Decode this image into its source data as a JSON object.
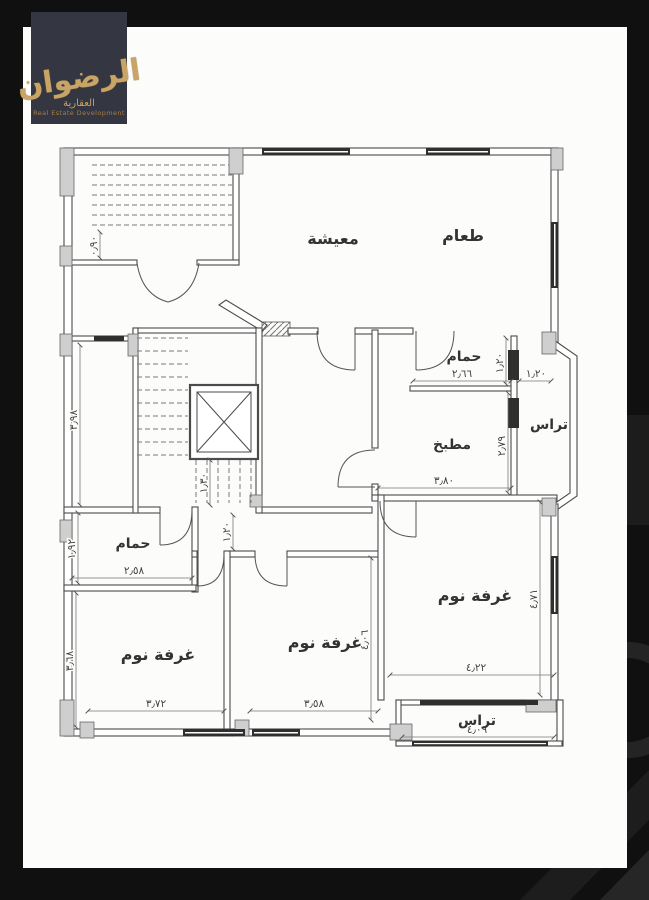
{
  "canvas": {
    "background": "#101010",
    "sheet_color": "#fcfcfa"
  },
  "logo": {
    "calligraphy": "الرضوان",
    "subtitle": "العقارية",
    "tagline": "Real Estate Development",
    "background": "#343641",
    "gold": "#c8a566"
  },
  "plan": {
    "line_color": "#4b4b4b",
    "rooms": [
      {
        "id": "living",
        "label": "معيشة"
      },
      {
        "id": "dining",
        "label": "طعام"
      },
      {
        "id": "bathroom-top",
        "label": "حمام"
      },
      {
        "id": "terrace-right",
        "label": "تراس"
      },
      {
        "id": "kitchen",
        "label": "مطبخ"
      },
      {
        "id": "bathroom-left",
        "label": "حمام"
      },
      {
        "id": "bedroom-left",
        "label": "غرفة نوم"
      },
      {
        "id": "bedroom-middle",
        "label": "غرفة نوم"
      },
      {
        "id": "bedroom-right",
        "label": "غرفة نوم"
      },
      {
        "id": "terrace-bottom",
        "label": "تراس"
      }
    ],
    "dimensions": {
      "bath_top_width": "٢٫٦٦",
      "bath_top_height": "١٫٢٠",
      "terrace_right_width": "١٫٢٠",
      "kitchen_height": "٢٫٧٩",
      "kitchen_width": "٣٫٨٠",
      "entry_landing": "٠٫٩٠",
      "stair_hall_upper": "٣٫٩٨",
      "stair_flight": "١٫٣٠",
      "hall_width": "١٫٢٠",
      "bath_left_width": "٢٫٥٨",
      "bath_left_height": "١٫٩٢",
      "bedroom_left_height": "٣٫٦٨",
      "bedroom_left_width": "٣٫٧٢",
      "bedroom_middle_width": "٣٫٥٨",
      "bedroom_middle_height": "٤٫٠٦",
      "bedroom_right_width": "٤٫٢٢",
      "bedroom_right_height": "٤٫٧١",
      "terrace_bottom_width": "٤٫٠٩"
    }
  }
}
